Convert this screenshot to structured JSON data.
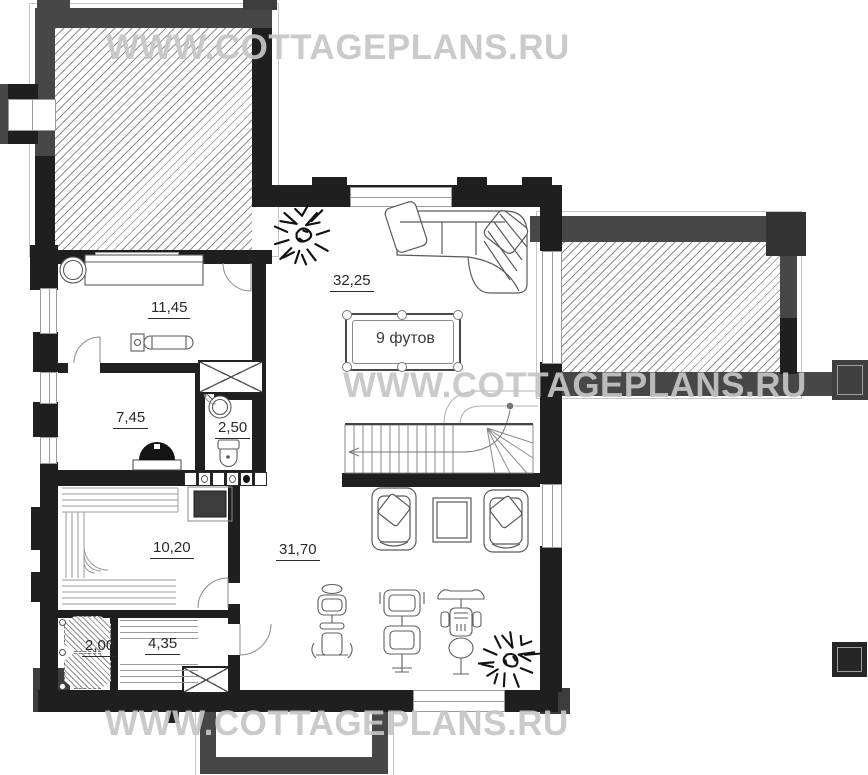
{
  "watermark": {
    "text": "WWW.COTTAGEPLANS.RU",
    "color": "#c6c6c6"
  },
  "room_labels": {
    "billiard_room": "32,25",
    "rest_room": "11,45",
    "steam_room": "7,45",
    "wc": "2,50",
    "sauna": "10,20",
    "gym": "31,70",
    "shower": "2,00",
    "hall": "4,35"
  },
  "billiard_table": {
    "size_label": "9 футов"
  },
  "colors": {
    "wall_black": "#1f1f1f",
    "wall_gray": "#474747",
    "hatch_line": "#8f8f8f",
    "furniture_line": "#666666",
    "label_text": "#2a2a2a",
    "watermark": "#c6c6c6"
  }
}
